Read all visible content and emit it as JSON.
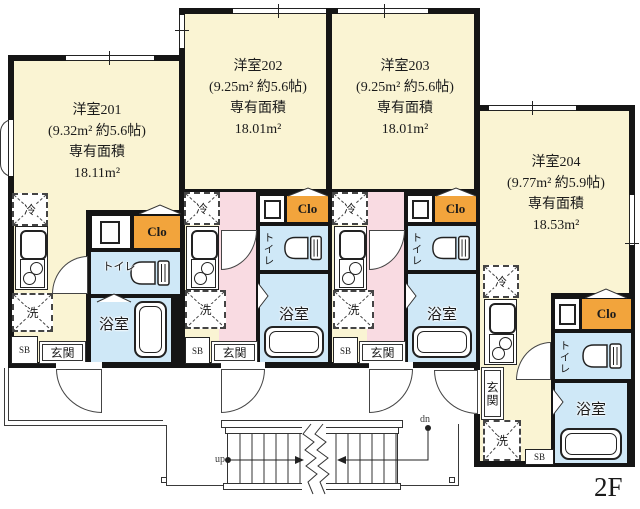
{
  "floor_label": "2F",
  "stairs": {
    "up": "up",
    "down": "dn"
  },
  "labels": {
    "fridge": "冷",
    "washer": "洗",
    "toilet": "トイレ",
    "bath": "浴室",
    "entrance": "玄関",
    "shoe_box": "SB",
    "closet": "Clo"
  },
  "units": {
    "u201": {
      "name": "洋室201",
      "dims": "(9.32m² 約5.6帖)",
      "area_label": "専有面積",
      "area": "18.11m²"
    },
    "u202": {
      "name": "洋室202",
      "dims": "(9.25m² 約5.6帖)",
      "area_label": "専有面積",
      "area": "18.01m²"
    },
    "u203": {
      "name": "洋室203",
      "dims": "(9.25m² 約5.6帖)",
      "area_label": "専有面積",
      "area": "18.01m²"
    },
    "u204": {
      "name": "洋室204",
      "dims": "(9.77m² 約5.9帖)",
      "area_label": "専有面積",
      "area": "18.53m²"
    }
  },
  "colors": {
    "room_yellow": "#faf4d3",
    "hall_pink": "#f9dbe2",
    "wet_blue": "#cfe8f7",
    "closet_orange": "#f2a43c",
    "wall_black": "#151515"
  }
}
